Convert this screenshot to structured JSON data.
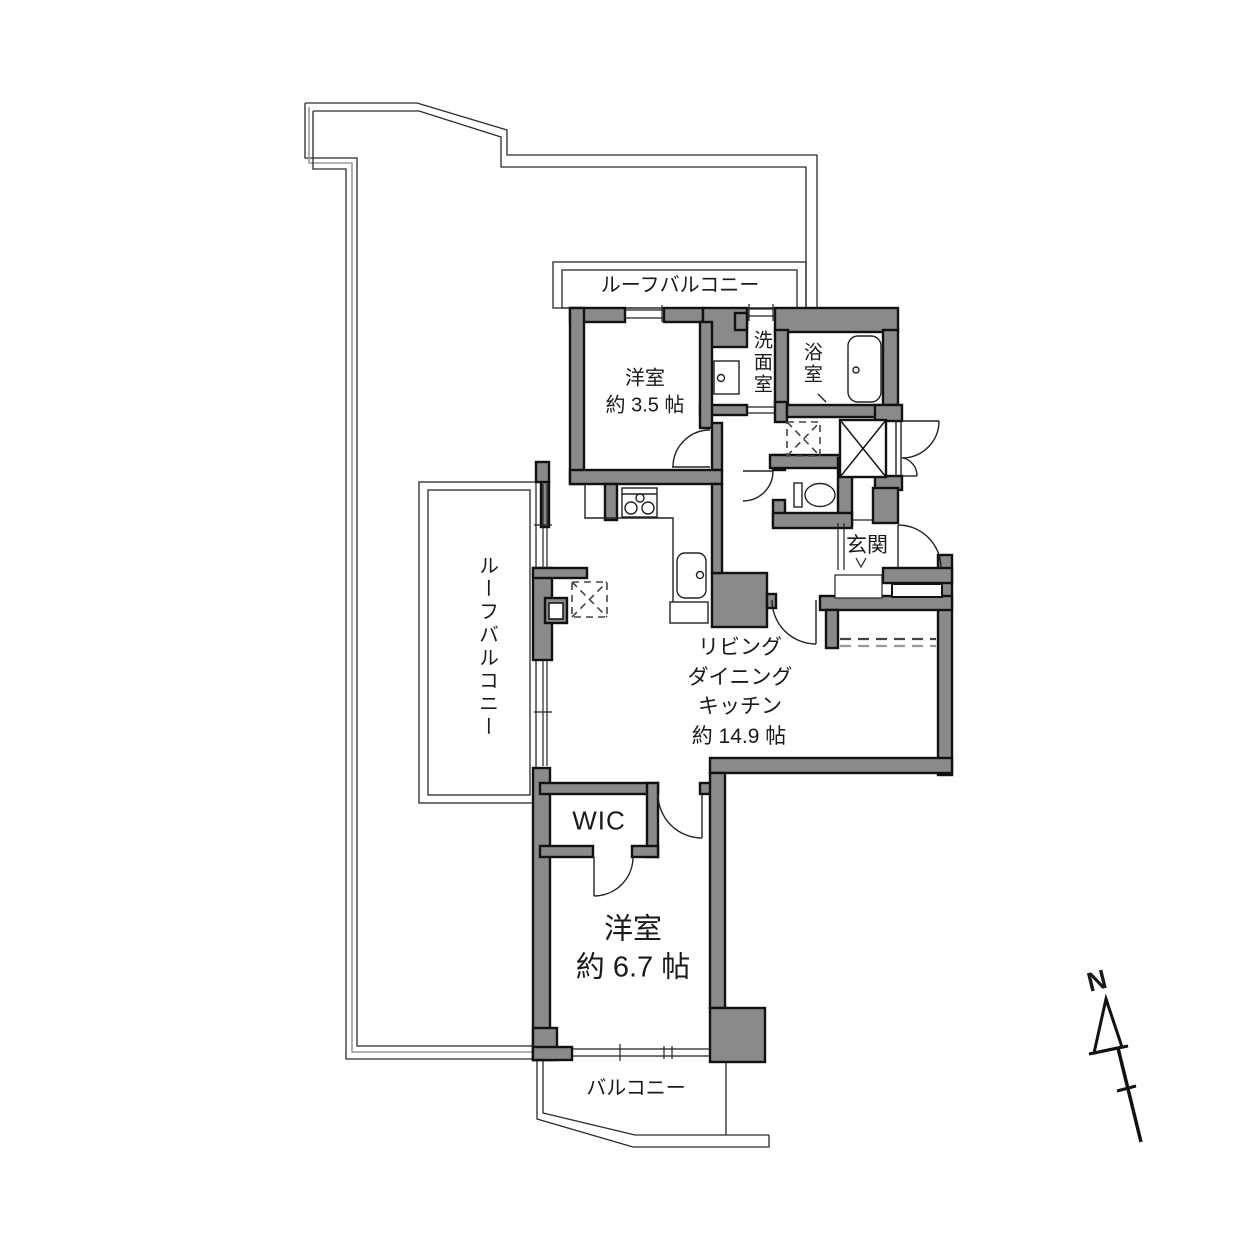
{
  "plan_title": "apartment-floor-plan",
  "labels": {
    "roof_balcony_top": "ルーフバルコニー",
    "roof_balcony_left": "ルーフバルコニー",
    "balcony": "バルコニー",
    "entrance": "玄関",
    "washroom": "洗面室",
    "bathroom": "浴室",
    "wic": "WIC"
  },
  "rooms": {
    "bedroom_small": {
      "name": "洋室",
      "size": "約 3.5 帖"
    },
    "bedroom_main": {
      "name": "洋室",
      "size": "約 6.7 帖"
    },
    "ldk": {
      "lines": [
        "リビング",
        "ダイニング",
        "キッチン"
      ],
      "size": "約 14.9 帖"
    }
  },
  "compass": {
    "label": "N"
  },
  "colors": {
    "wall_fill": "#8a8a8a",
    "wall_edge": "#111111",
    "thin_line": "#2a2a2a",
    "outline_gray": "#999999",
    "background": "#ffffff"
  }
}
